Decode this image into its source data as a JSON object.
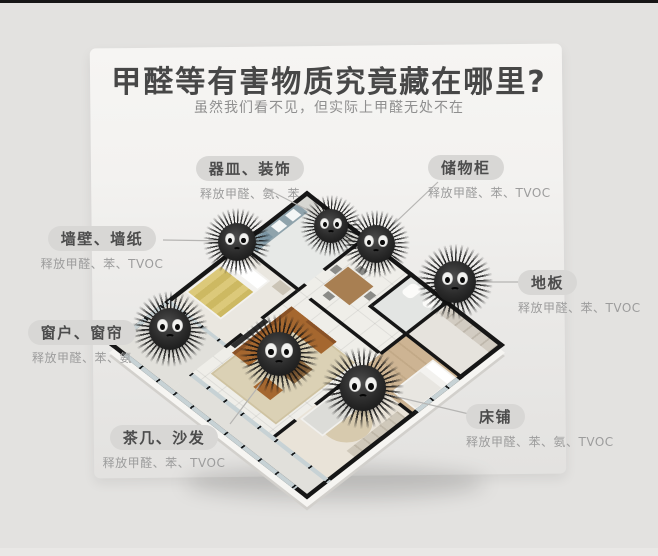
{
  "page": {
    "background": "#e3e2e0",
    "top_bar_color": "#161616",
    "card_color": "#f5f4f2"
  },
  "header": {
    "title": "甲醛等有害物质究竟藏在哪里?",
    "subtitle": "虽然我们看不见，但实际上甲醛无处不在"
  },
  "callouts": [
    {
      "id": "vessels-decor",
      "name": "器皿、装饰",
      "sub": "释放甲醛、氨、苯"
    },
    {
      "id": "storage-cabinet",
      "name": "储物柜",
      "sub": "释放甲醛、苯、TVOC"
    },
    {
      "id": "walls-wallpaper",
      "name": "墙壁、墙纸",
      "sub": "释放甲醛、苯、TVOC"
    },
    {
      "id": "floor",
      "name": "地板",
      "sub": "释放甲醛、苯、TVOC"
    },
    {
      "id": "windows-curtains",
      "name": "窗户、窗帘",
      "sub": "释放甲醛、苯、氨"
    },
    {
      "id": "tea-table-sofa",
      "name": "茶几、沙发",
      "sub": "释放甲醛、苯、TVOC"
    },
    {
      "id": "bed",
      "name": "床铺",
      "sub": "释放甲醛、苯、氨、TVOC"
    }
  ],
  "colors": {
    "pill_bg": "#d8d7d5",
    "pill_text": "#4c4c4c",
    "sub_text": "#9c9c9c",
    "title_text": "#474747",
    "wall_black": "#161616",
    "leader_line": "#b6b5b3",
    "sofa_brown": "#a5672f",
    "rug_beige": "#dbd1b5",
    "blanket_yellow": "#dcc97a"
  }
}
